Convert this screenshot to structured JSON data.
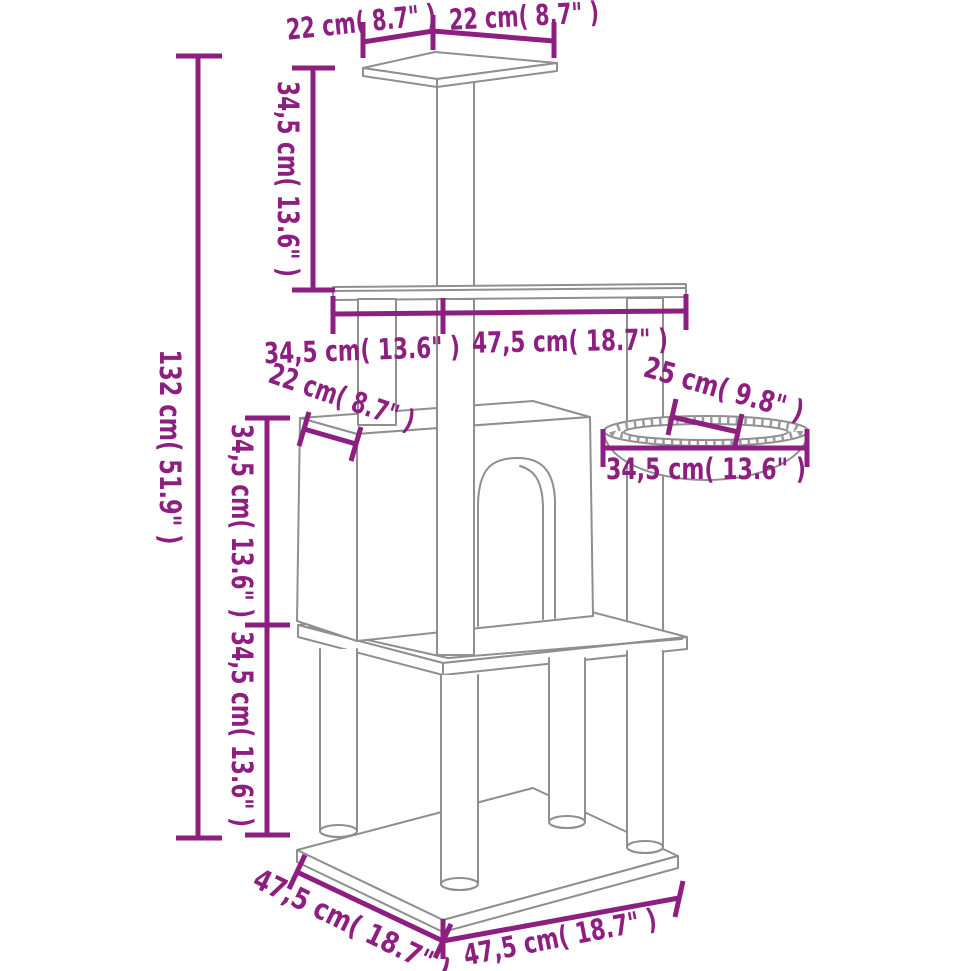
{
  "diagram": {
    "title": "cat-tree-dimension-diagram",
    "colors": {
      "dimension_accent": "#8d1f80",
      "artwork_line": "#8f8f8f",
      "background": "#ffffff"
    },
    "labels": {
      "top_width_left": "22 cm( 8.7\" )",
      "top_width_right": "22 cm( 8.7\" )",
      "top_pole_height": "34,5 cm( 13.6\" )",
      "total_height": "132 cm( 51.9\" )",
      "middle_platform_depth": "34,5 cm( 13.6\" )",
      "middle_platform_width": "47,5 cm( 18.7\" )",
      "house_roof_edge": "22 cm( 8.7\" )",
      "basket_inner_width": "25 cm( 9.8\" )",
      "basket_outer_width": "34,5 cm( 13.6\" )",
      "house_section_height": "34,5 cm( 13.6\" )",
      "lower_section_height": "34,5 cm( 13.6\" )",
      "base_depth": "47,5 cm( 18.7\" )",
      "base_width": "47,5 cm( 18.7\" )"
    }
  }
}
